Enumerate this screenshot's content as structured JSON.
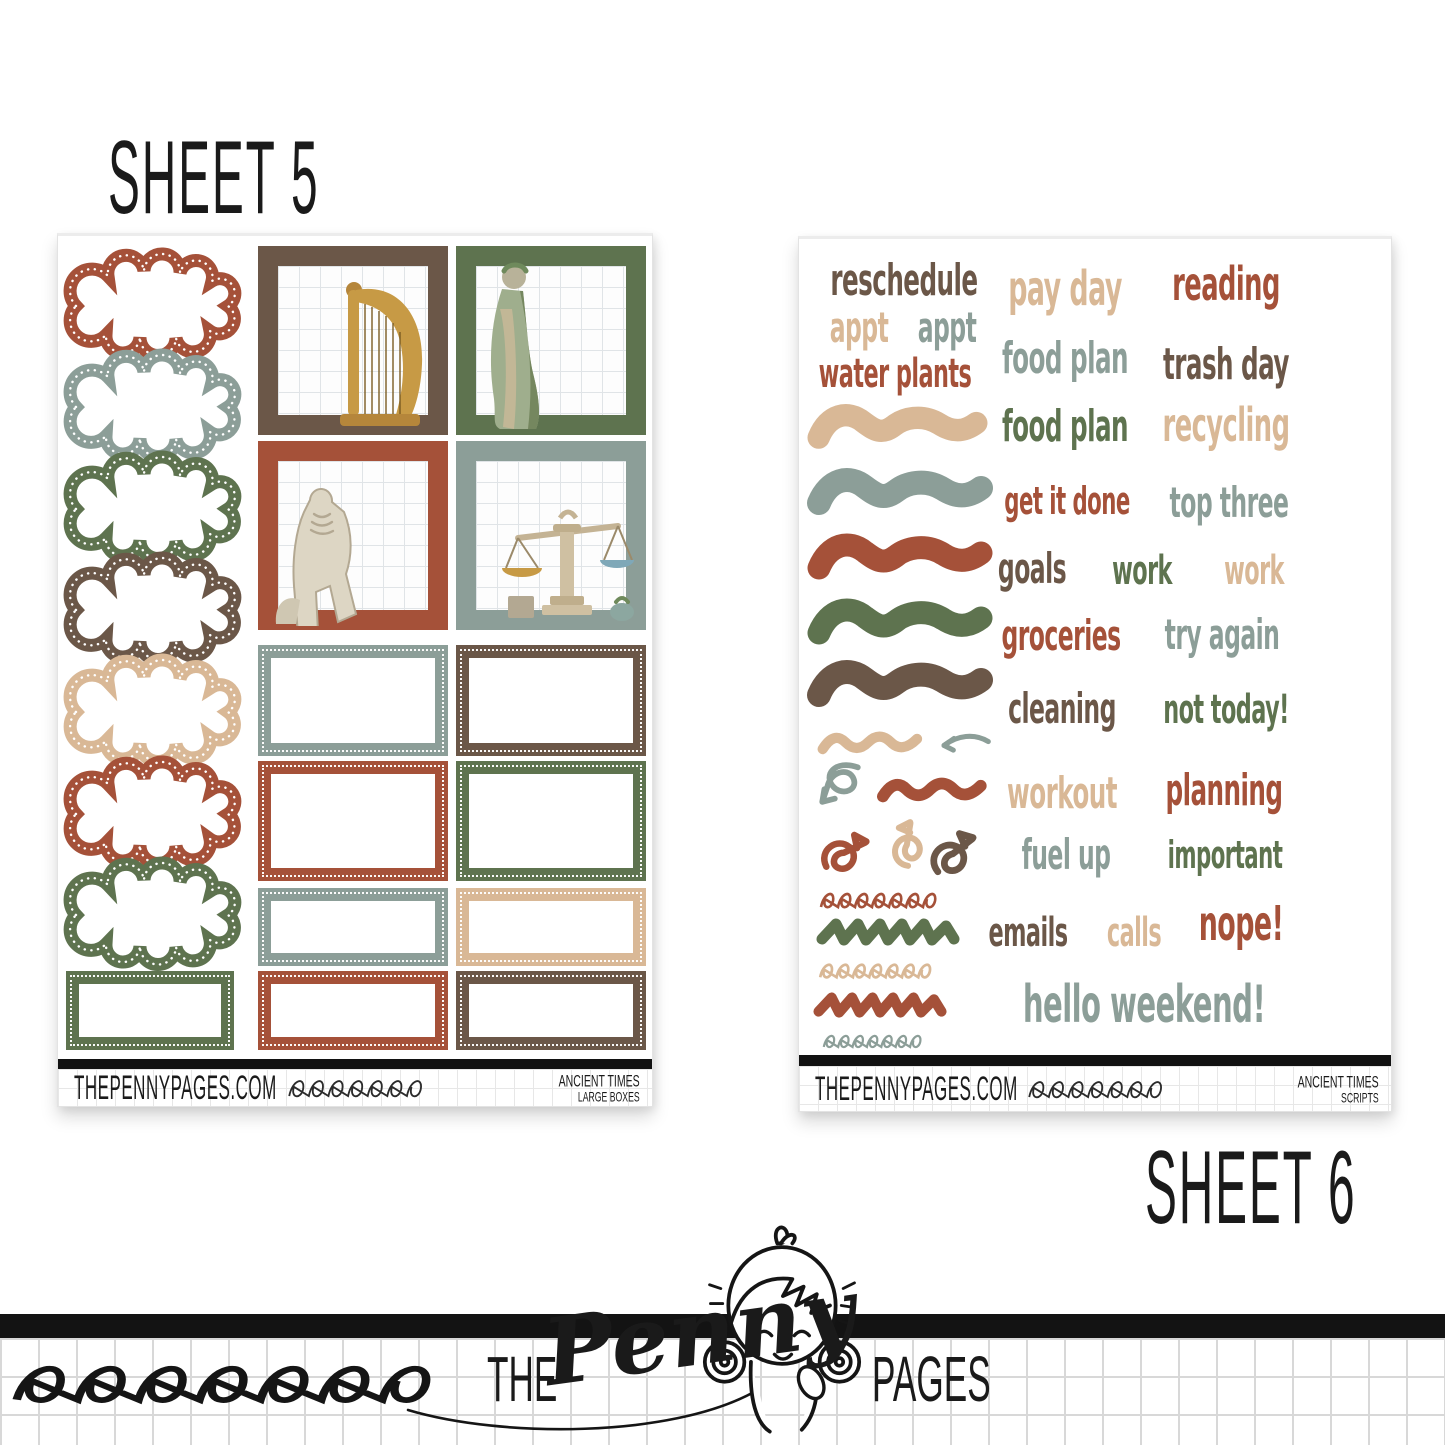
{
  "palette": {
    "rust": "#A55139",
    "olive_green": "#5E734F",
    "brown": "#6B5748",
    "tan": "#D9B896",
    "sage_gray": "#8C9E98",
    "bar_black": "#121212"
  },
  "labels": {
    "sheet5_title": "SHEET 5",
    "sheet6_title": "SHEET 6"
  },
  "sheet5": {
    "clouds": [
      "#A55139",
      "#8C9E98",
      "#5E734F",
      "#6B5748",
      "#D9B896",
      "#A55139",
      "#5E734F"
    ],
    "big_boxes": [
      {
        "color": "#6B5748",
        "image": "harp"
      },
      {
        "color": "#5E734F",
        "image": "goddess-statue"
      },
      {
        "color": "#A55139",
        "image": "zeus-statue"
      },
      {
        "color": "#8C9E98",
        "image": "scales-of-justice"
      }
    ],
    "dot_boxes": [
      {
        "color": "#8C9E98"
      },
      {
        "color": "#6B5748"
      },
      {
        "color": "#A55139"
      },
      {
        "color": "#5E734F"
      },
      {
        "color": "#8C9E98"
      },
      {
        "color": "#D9B896"
      },
      {
        "color": "#5E734F"
      },
      {
        "color": "#A55139"
      },
      {
        "color": "#6B5748"
      }
    ],
    "footer": {
      "site": "THEPENNYPAGES.COM",
      "collection": "ANCIENT TIMES",
      "subtitle": "LARGE BOXES"
    }
  },
  "sheet6": {
    "words": [
      {
        "text": "reschedule",
        "color": "#6B5748"
      },
      {
        "text": "pay day",
        "color": "#D9B896"
      },
      {
        "text": "reading",
        "color": "#A55139"
      },
      {
        "text": "appt",
        "color": "#D9B896"
      },
      {
        "text": "appt",
        "color": "#8C9E98"
      },
      {
        "text": "water plants",
        "color": "#A55139"
      },
      {
        "text": "food plan",
        "color": "#8C9E98"
      },
      {
        "text": "trash day",
        "color": "#6B5748"
      },
      {
        "text": "food plan",
        "color": "#5E734F"
      },
      {
        "text": "recycling",
        "color": "#D9B896"
      },
      {
        "text": "get it done",
        "color": "#A55139"
      },
      {
        "text": "top three",
        "color": "#8C9E98"
      },
      {
        "text": "goals",
        "color": "#6B5748"
      },
      {
        "text": "work",
        "color": "#5E734F"
      },
      {
        "text": "work",
        "color": "#D9B896"
      },
      {
        "text": "groceries",
        "color": "#A55139"
      },
      {
        "text": "try again",
        "color": "#8C9E98"
      },
      {
        "text": "cleaning",
        "color": "#6B5748"
      },
      {
        "text": "not today!",
        "color": "#5E734F"
      },
      {
        "text": "workout",
        "color": "#D9B896"
      },
      {
        "text": "planning",
        "color": "#A55139"
      },
      {
        "text": "fuel up",
        "color": "#8C9E98"
      },
      {
        "text": "important",
        "color": "#5E734F"
      },
      {
        "text": "emails",
        "color": "#6B5748"
      },
      {
        "text": "calls",
        "color": "#D9B896"
      },
      {
        "text": "nope!",
        "color": "#A55139"
      },
      {
        "text": "hello weekend!",
        "color": "#8C9E98"
      }
    ],
    "doodles": [
      {
        "type": "brush-stroke",
        "color": "#D9B896"
      },
      {
        "type": "brush-stroke",
        "color": "#8C9E98"
      },
      {
        "type": "brush-stroke",
        "color": "#A55139"
      },
      {
        "type": "brush-stroke",
        "color": "#5E734F"
      },
      {
        "type": "brush-stroke",
        "color": "#6B5748"
      },
      {
        "type": "squiggle",
        "color": "#D9B896"
      },
      {
        "type": "curve-arrow-left",
        "color": "#8C9E98"
      },
      {
        "type": "loop-arrow",
        "color": "#8C9E98"
      },
      {
        "type": "squiggle",
        "color": "#A55139"
      },
      {
        "type": "curl-arrow",
        "color": "#A55139"
      },
      {
        "type": "curl-arrow",
        "color": "#D9B896"
      },
      {
        "type": "curl-arrow",
        "color": "#6B5748"
      },
      {
        "type": "loop-line",
        "color": "#A55139"
      },
      {
        "type": "zigzag",
        "color": "#5E734F"
      },
      {
        "type": "loop-line",
        "color": "#D9B896"
      },
      {
        "type": "zigzag",
        "color": "#A55139"
      },
      {
        "type": "loop-line",
        "color": "#8C9E98"
      }
    ],
    "footer": {
      "site": "THEPENNYPAGES.COM",
      "collection": "ANCIENT TIMES",
      "subtitle": "SCRIPTS"
    }
  },
  "logo": {
    "the": "THE",
    "penny": "Penny",
    "pages": "PAGES"
  }
}
